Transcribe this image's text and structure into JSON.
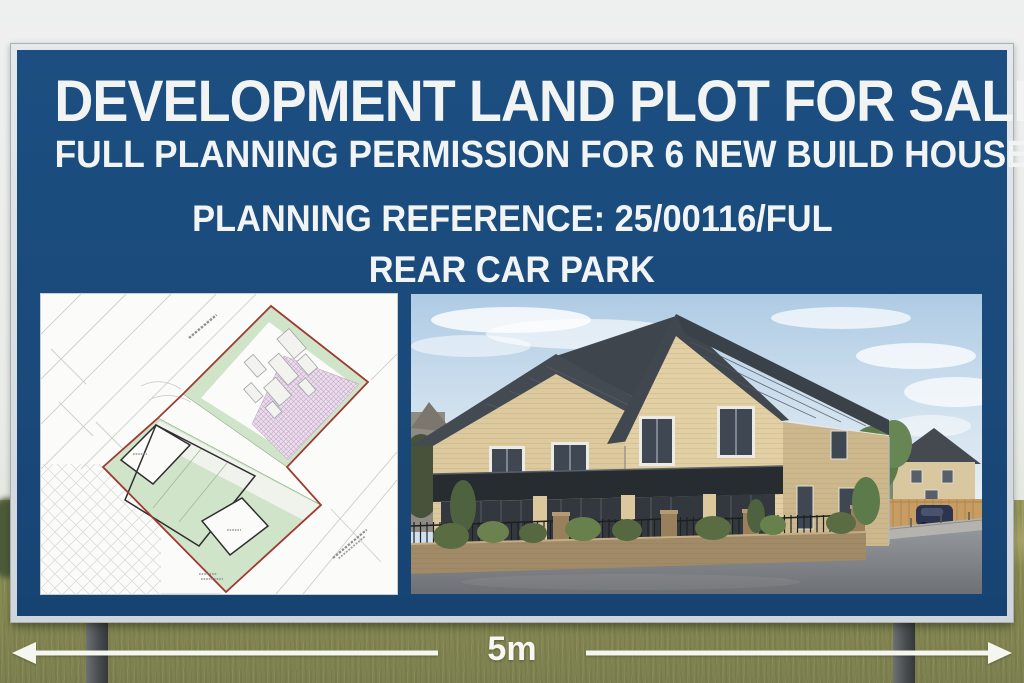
{
  "scene": {
    "setting": "grass-field",
    "sky_color": "#ebedec",
    "grass_color": "#8b8d55",
    "post_color": "#4a4e51"
  },
  "signboard": {
    "frame_color": "#d6dadd",
    "panel_color": "#1a4a7b",
    "text_color": "#f1f4f3",
    "headline1": "DEVELOPMENT LAND PLOT FOR SALE",
    "headline2": "FULL PLANNING PERMISSION FOR 6 NEW BUILD HOUSES",
    "reference_line": "PLANNING REFERENCE: 25/00116/FUL",
    "location_line": "REAR CAR PARK"
  },
  "site_plan": {
    "name": "site-plan-drawing",
    "paper_color": "#fbfbf9",
    "boundary_color": "#9e3a31",
    "greenspace_color": "#cfe4c9",
    "hatched_area_color": "#ecdded"
  },
  "house_photo": {
    "name": "new-build-houses-render",
    "brick_color": "#ddc99e",
    "roof_color": "#40474f",
    "sky_color": "#aecbe4",
    "fence_color": "#c79d63"
  },
  "scale_bar": {
    "label": "5m",
    "arrow_color": "#f6f6f1"
  }
}
